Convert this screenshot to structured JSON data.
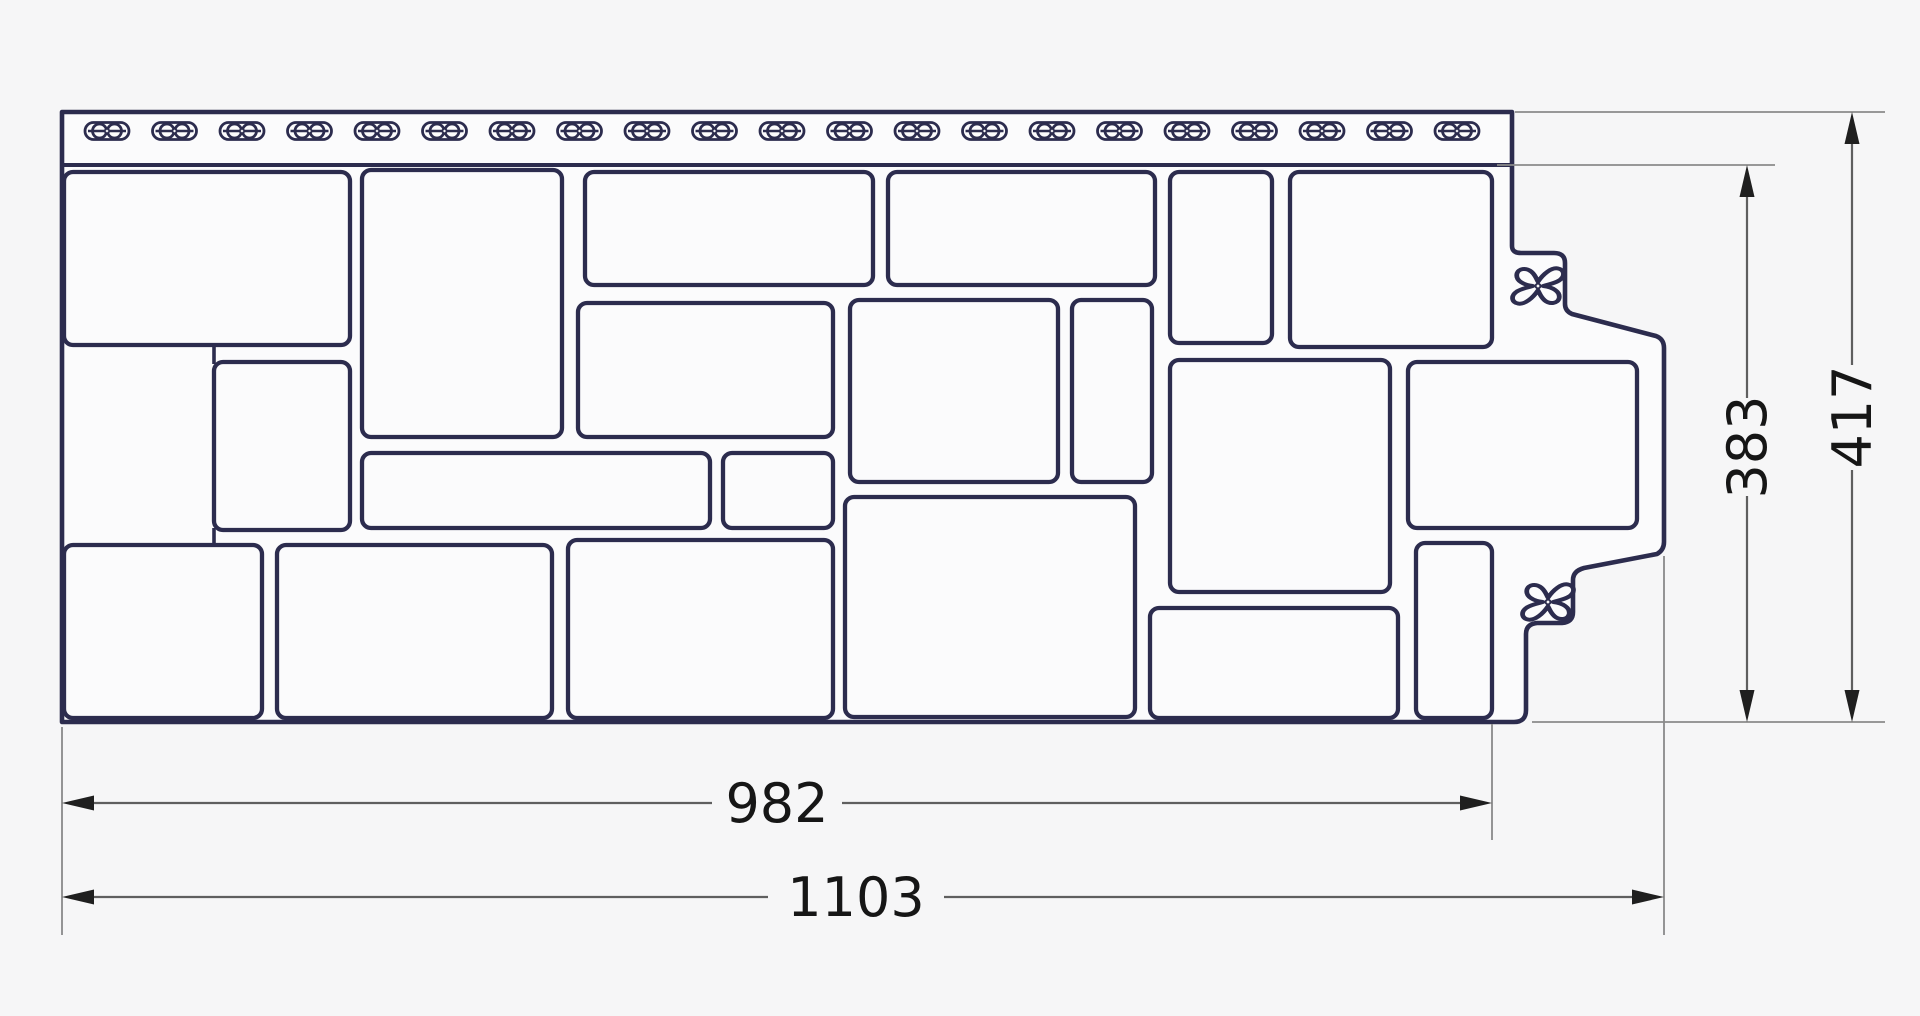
{
  "dimensions": {
    "width_inner": "982",
    "width_total": "1103",
    "height_inner": "383",
    "height_total": "417"
  },
  "panel": {
    "description": "facade siding panel technical drawing, stone pattern",
    "nail_slots": {
      "count": 21,
      "start_x": 107,
      "spacing": 67.5,
      "y": 131
    },
    "stone_count": 20,
    "lock_symbols": 2
  },
  "colors": {
    "line": "#2c2c4e",
    "dimension_line": "#5f5f5f",
    "extension_line": "#8a8a8a",
    "dimension_text": "#161616",
    "background": "#f6f6f7",
    "panel_fill": "#fbfbfc"
  }
}
